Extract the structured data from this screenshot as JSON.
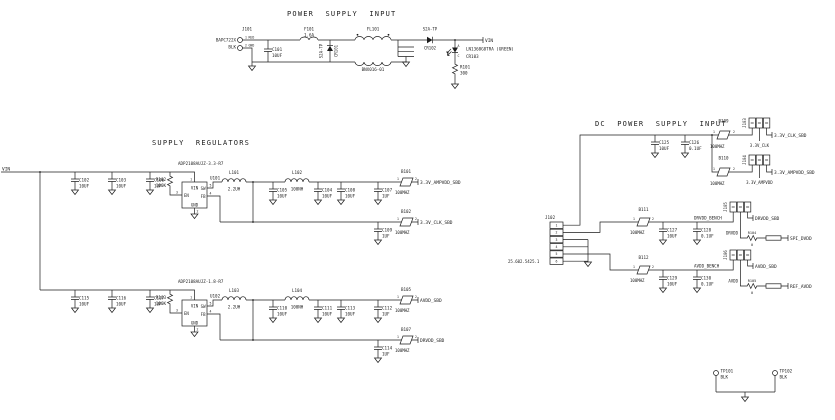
{
  "common": {
    "p1": "1",
    "p2": "2",
    "p3": "3",
    "p4": "4",
    "p5": "5",
    "p6": "6"
  },
  "psi": {
    "title": "POWER SUPPLY INPUT",
    "j101_ref": "J101",
    "j101_part": "BAPC722X",
    "j101_wire": "BLK",
    "j101_p1_name": "RED",
    "j101_p2_name": "GND",
    "c101_ref": "C101",
    "c101_val": "10UF",
    "f101_ref": "F101",
    "f101_val": "1.6A",
    "cr101_ref": "CR101",
    "cr101_part": "S2A-TP",
    "fl101_ref": "FL101",
    "fl101_part": "BNX016-01",
    "cr102_ref": "CR102",
    "cr102_part": "S2A-TP",
    "vin_net": "VIN",
    "cr103_ref": "CR103",
    "cr103_part": "LN1368G8TRA (GREEN)",
    "cr103_a": "A",
    "cr103_c": "C",
    "r101_ref": "R101",
    "r101_val": "300"
  },
  "sr": {
    "title": "SUPPLY REGULATORS",
    "vin_net": "VIN",
    "u101_part": "ADP2108AUJZ-3.3-R7",
    "u101_ref": "U101",
    "u102_part": "ADP2108AUJZ-1.8-R7",
    "u102_ref": "U102",
    "pin_vin": "VIN",
    "pin_en": "EN",
    "pin_gnd": "GND",
    "pin_sw": "SW",
    "pin_fb": "FB",
    "c102_ref": "C102",
    "c102_val": "10UF",
    "c103_ref": "C103",
    "c103_val": "10UF",
    "c106_ref": "C106",
    "c106_val": "1UF",
    "r102_ref": "R102",
    "r102_val": "100K",
    "l101_ref": "L101",
    "l101_val": "2.2UH",
    "l102_ref": "L102",
    "l102_val": "100NH",
    "c105_ref": "C105",
    "c105_val": "10UF",
    "c104_ref": "C104",
    "c104_val": "10UF",
    "c108_ref": "C108",
    "c108_val": "10UF",
    "c107_ref": "C107",
    "c107_val": "1UF",
    "c109_ref": "C109",
    "c109_val": "1UF",
    "b101_ref": "B101",
    "b101_val": "100MHZ",
    "b102_ref": "B102",
    "b102_val": "100MHZ",
    "net_ampvdd": "3.3V_AMPVDD_SBD",
    "net_clk": "3.3V_CLK_SBD",
    "c115_ref": "C115",
    "c115_val": "10UF",
    "c116_ref": "C116",
    "c116_val": "10UF",
    "c117_ref": "C117",
    "c117_val": "1UF",
    "r103_ref": "R103",
    "r103_val": "100K",
    "l103_ref": "L103",
    "l103_val": "2.2UH",
    "l104_ref": "L104",
    "l104_val": "100NH",
    "c110_ref": "C110",
    "c110_val": "10UF",
    "c111_ref": "C111",
    "c111_val": "10UF",
    "c113_ref": "C113",
    "c113_val": "10UF",
    "c112_ref": "C112",
    "c112_val": "1UF",
    "c114_ref": "C114",
    "c114_val": "1UF",
    "b105_ref": "B105",
    "b105_val": "100MHZ",
    "b107_ref": "B107",
    "b107_val": "100MHZ",
    "net_avdd": "AVDD_SBD",
    "net_drvdd": "DRVDD_SBD"
  },
  "dc": {
    "title": "DC POWER SUPPLY INPUT",
    "j102_ref": "J102",
    "j102_part": "25.602.5425.1",
    "c125_ref": "C125",
    "c125_val": "10UF",
    "c126_ref": "C126",
    "c126_val": "0.1UF",
    "b109_ref": "B109",
    "b109_val": "100MHZ",
    "b110_ref": "B110",
    "b110_val": "100MHZ",
    "j103_ref": "J103",
    "j104_ref": "J104",
    "net_clk_sbd": "3.3V_CLK_SBD",
    "net_clk": "3.3V_CLK",
    "net_amp_sbd": "3.3V_AMPVDD_SBD",
    "net_amp": "3.3V_AMPVDD",
    "b111_ref": "B111",
    "b111_val": "100MHZ",
    "c127_ref": "C127",
    "c127_val": "10UF",
    "c128_ref": "C128",
    "c128_val": "0.1UF",
    "net_drvdd_bench": "DRVDD_BENCH",
    "j105_ref": "J105",
    "net_drvdd_sbd": "DRVDD_SBD",
    "drvdd": "DRVDD",
    "r104_ref": "R104",
    "r104_val": "0",
    "net_spi_dvdd": "SPI_DVDD",
    "b112_ref": "B112",
    "b112_val": "100MHZ",
    "c129_ref": "C129",
    "c129_val": "10UF",
    "c130_ref": "C130",
    "c130_val": "0.1UF",
    "net_avdd_bench": "AVDD_BENCH",
    "j106_ref": "J106",
    "net_avdd_sbd": "AVDD_SBD",
    "avdd": "AVDD",
    "r105_ref": "R105",
    "r105_val": "0",
    "net_ref_avdd": "REF_AVDD"
  },
  "tp": {
    "tp101_ref": "TP101",
    "tp101_val": "BLK",
    "tp102_ref": "TP102",
    "tp102_val": "BLK"
  }
}
